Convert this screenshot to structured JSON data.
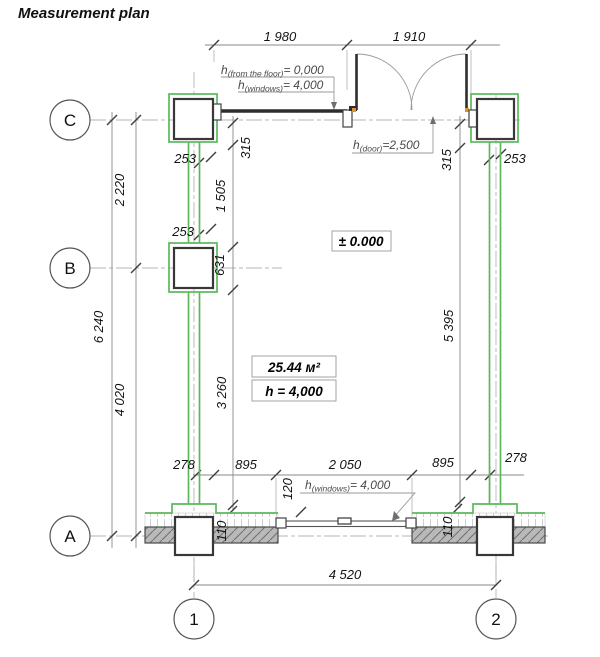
{
  "title": "Measurement plan",
  "grid_bubbles": {
    "c": "C",
    "b": "B",
    "a": "A",
    "one": "1",
    "two": "2"
  },
  "dimensions": {
    "top_window": "1 980",
    "top_door": "1 910",
    "left_c_b": "2 220",
    "left_total": "6 240",
    "left_b_a": "4 020",
    "wall_left_upper": "253",
    "wall_left_lower": "253",
    "wall_right": "253",
    "int_315_left": "315",
    "int_1505": "1 505",
    "int_631": "631",
    "int_3260": "3 260",
    "int_315_right": "315",
    "int_5395": "5 395",
    "bot_278_left": "278",
    "bot_895_left": "895",
    "bot_2050": "2 050",
    "bot_895_right": "895",
    "bot_278_right": "278",
    "bot_120": "120",
    "bot_110_left": "110",
    "bot_110_right": "110",
    "bot_total": "4 520"
  },
  "annotations": {
    "floor_level_note": {
      "base": "h",
      "sub": "(from the floor)",
      "val": "= 0,000"
    },
    "windows_top_note": {
      "base": "h",
      "sub": "(windows)",
      "val": "= 4,000"
    },
    "door_note": {
      "base": "h",
      "sub": "(door)",
      "val": "=2,500"
    },
    "windows_bottom_note": {
      "base": "h",
      "sub": "(windows)",
      "val": "= 4,000"
    },
    "level_mark": "± 0.000",
    "room_area": "25.44 м²",
    "room_height": "h = 4,000"
  },
  "colors": {
    "wall_green": "#5cb85c",
    "hatch_fill": "#b9b9b9",
    "hinge_orange": "#e09035",
    "line_dark": "#2d2d2d",
    "dim_grey": "#8a8a8a"
  }
}
